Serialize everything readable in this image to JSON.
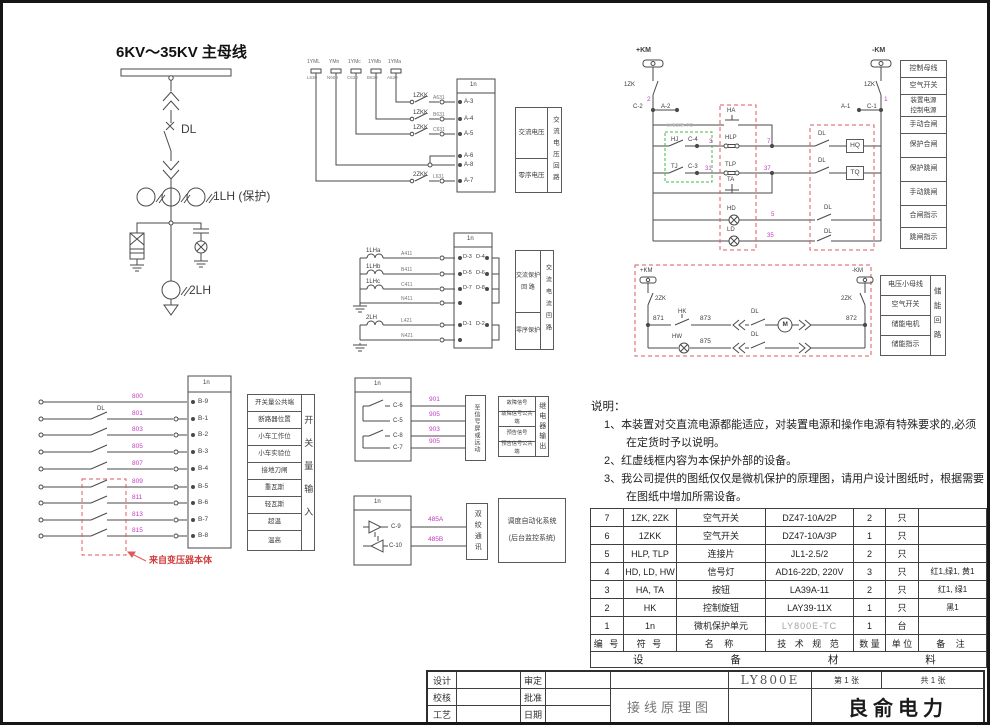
{
  "single_line": {
    "busbar": "6KV～35KV 主母线",
    "dl": "DL",
    "ct_protection": "1LH (保护)",
    "ct_zero": "2LH"
  },
  "voltage": {
    "unit": "1n",
    "pts": [
      {
        "name": "1YML",
        "wire": "L630"
      },
      {
        "name": "YMn",
        "wire": "N600"
      },
      {
        "name": "1YMc",
        "wire": "C630"
      },
      {
        "name": "1YMb",
        "wire": "B630"
      },
      {
        "name": "1YMa",
        "wire": "A630"
      }
    ],
    "rows": [
      {
        "sw": "1ZKK",
        "wire": "A631",
        "term": "A-3"
      },
      {
        "sw": "1ZKK",
        "wire": "B631",
        "term": "A-4"
      },
      {
        "sw": "1ZKK",
        "wire": "C631",
        "term": "A-5"
      },
      {
        "term": "A-6"
      },
      {
        "term": "A-8"
      },
      {
        "sw": "2ZKK",
        "wire": "L631",
        "term": "A-7"
      }
    ],
    "box_ac": "交流电压",
    "box_zero": "零序电压",
    "loop": "交流电压回路"
  },
  "current": {
    "unit": "1n",
    "rows": [
      {
        "ct": "1LHa",
        "wire": "A411",
        "l": "D-3",
        "r": "D-4"
      },
      {
        "ct": "1LHb",
        "wire": "B411",
        "l": "D-5",
        "r": "D-6"
      },
      {
        "ct": "1LHc",
        "wire": "C411",
        "l": "D-7",
        "r": "D-8"
      },
      {
        "wire": "N411"
      },
      {
        "ct": "2LH",
        "wire": "L421",
        "l": "D-1",
        "r": "D-2"
      },
      {
        "wire": "N421"
      }
    ],
    "box_prot": "交流保护\n回  路",
    "box_zero": "零序保护",
    "loop": "交流电流回路"
  },
  "digital": {
    "unit": "1n",
    "dl": "DL",
    "rows": [
      {
        "wire": "800",
        "term": "B-9",
        "label": "开关量公共端"
      },
      {
        "wire": "801",
        "term": "B-1",
        "label": "断路器位置"
      },
      {
        "wire": "803",
        "term": "B-2",
        "label": "小车工作位"
      },
      {
        "wire": "805",
        "term": "B-3",
        "label": "小车实验位"
      },
      {
        "wire": "807",
        "term": "B-4",
        "label": "接地刀闸"
      },
      {
        "wire": "809",
        "term": "B-5",
        "label": "重瓦斯"
      },
      {
        "wire": "811",
        "term": "B-6",
        "label": "轻瓦斯"
      },
      {
        "wire": "813",
        "term": "B-7",
        "label": "超温"
      },
      {
        "wire": "815",
        "term": "B-8",
        "label": "温高"
      }
    ],
    "group": "开关量输入",
    "note": "来自变压器本体"
  },
  "relay": {
    "unit": "1n",
    "rows": [
      {
        "term": "C-6",
        "wire": "901",
        "label": "故障信号"
      },
      {
        "term": "C-5",
        "wire": "905",
        "label": "故障信号公共端"
      },
      {
        "term": "C-8",
        "wire": "903",
        "label": "预告信号"
      },
      {
        "term": "C-7",
        "wire": "905",
        "label": "预告信号公共端"
      }
    ],
    "dest": "至信号屏或远动",
    "group": "继电器输出"
  },
  "comm": {
    "unit": "1n",
    "rows": [
      {
        "term": "C-9",
        "wire": "485A"
      },
      {
        "term": "C-10",
        "wire": "485B"
      }
    ],
    "medium": "双绞通讯",
    "dest": "调度自动化系统\n(后台监控系统)"
  },
  "control": {
    "pos_bus": "+KM",
    "neg_bus": "-KM",
    "zk_left": "1ZK",
    "zk_right": "1ZK",
    "wire_pos": "2",
    "wire_neg": "1",
    "term_c2": "C-2",
    "term_a2": "A-2",
    "term_a1": "A-1",
    "term_c1": "C-1",
    "unit_tag": "LY800E-TC",
    "hj": "HJ",
    "hj_term": "C-4",
    "tj": "TJ",
    "tj_term": "C-3",
    "ha": "HA",
    "hlp": "HLP",
    "tlp": "TLP",
    "ta": "TA",
    "hd": "HD",
    "ld": "LD",
    "hq": "HQ",
    "tq": "TQ",
    "dl1": "DL",
    "dl2": "DL",
    "dl3": "DL",
    "dl4": "DL",
    "w3": "3",
    "w7": "7",
    "w31": "31",
    "w37": "37",
    "w5": "5",
    "w35": "35",
    "rows": [
      "控制母线",
      "空气开关",
      "装置电源\n控制电源",
      "手动合闸",
      "保护合闸",
      "保护跳闸",
      "手动跳闸",
      "合闸指示",
      "跳闸指示"
    ]
  },
  "storage": {
    "pos_bus": "+KM",
    "neg_bus": "-KM",
    "zk_left": "2ZK",
    "zk_right": "2ZK",
    "w871": "871",
    "w873": "873",
    "w875": "875",
    "w872": "872",
    "hk": "HK",
    "hw": "HW",
    "dl1": "DL",
    "dl2": "DL",
    "motor": "M",
    "rows": [
      "电压小母线",
      "空气开关",
      "储能电机",
      "储能指示"
    ],
    "loop": "储能回路"
  },
  "notes": {
    "title": "说明：",
    "l1": "1、本装置对交直流电源都能适应，对装置电源和操作电源有特殊要求的,必须",
    "l2": "在定货时予以说明。",
    "l3": "2、红虚线框内容为本保护外部的设备。",
    "l4": "3、我公司提供的图纸仅仅是微机保护的原理图，请用户设计图纸时，根据需要",
    "l5": "在图纸中增加所需设备。"
  },
  "materials": {
    "headers": [
      "编 号",
      "符 号",
      "名 称",
      "技 术 规 范",
      "数 量",
      "单 位",
      "备 注"
    ],
    "rows": [
      [
        "7",
        "1ZK, 2ZK",
        "空气开关",
        "DZ47-10A/2P",
        "2",
        "只",
        ""
      ],
      [
        "6",
        "1ZKK",
        "空气开关",
        "DZ47-10A/3P",
        "1",
        "只",
        ""
      ],
      [
        "5",
        "HLP, TLP",
        "连接片",
        "JL1-2.5/2",
        "2",
        "只",
        ""
      ],
      [
        "4",
        "HD, LD, HW",
        "信号灯",
        "AD16-22D, 220V",
        "3",
        "只",
        "红1,绿1, 黄1"
      ],
      [
        "3",
        "HA, TA",
        "按钮",
        "LA39A-11",
        "2",
        "只",
        "红1, 绿1"
      ],
      [
        "2",
        "HK",
        "控制旋钮",
        "LAY39-11X",
        "1",
        "只",
        "黑1"
      ],
      [
        "1",
        "1n",
        "微机保护单元",
        "LY800E-TC",
        "1",
        "台",
        ""
      ]
    ],
    "footer": "设 备 材 料 表"
  },
  "titleblock": {
    "design": "设计",
    "check": "校核",
    "craft": "工艺",
    "approve": "审定",
    "ratify": "批准",
    "date": "日期",
    "drawing": "接线原理图",
    "model": "LY800E",
    "sheet": "第 1 张",
    "total": "共 1 张",
    "company": "良俞电力"
  }
}
